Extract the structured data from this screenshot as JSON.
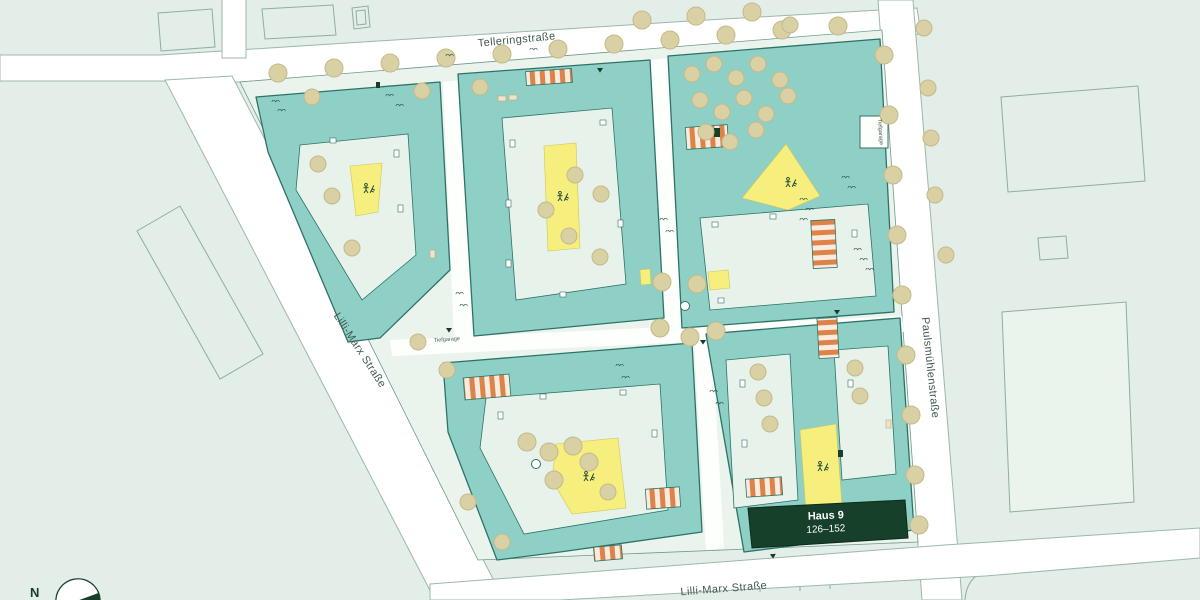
{
  "streets": {
    "top": "Telleringstraße",
    "left": "Lilli-Marx Straße",
    "bottom": "Lilli-Marx Straße",
    "right": "Paulsmühlenstraße"
  },
  "labels": {
    "tiefgarage": "Tiefgarage",
    "compass_north": "N"
  },
  "highlight": {
    "name": "Haus 9",
    "range": "126–152"
  },
  "colors": {
    "bg": "#e2eee7",
    "parcel_line": "#8fae9f",
    "street": "#ffffff",
    "street_line": "#9cb8aa",
    "site_base": "#eaf4ed",
    "building": "#8ed0c5",
    "building_line": "#2e7266",
    "courtyard": "#e7f2ea",
    "play": "#f6ef7e",
    "tree": "#d9d0a4",
    "tree_line": "#c4b98a",
    "parking": "#dd8348",
    "parking_light": "#f8ece0",
    "highlight": "#17402a",
    "path": "#fdfffd",
    "label": "#42584f",
    "icon": "#1d4a3a"
  }
}
